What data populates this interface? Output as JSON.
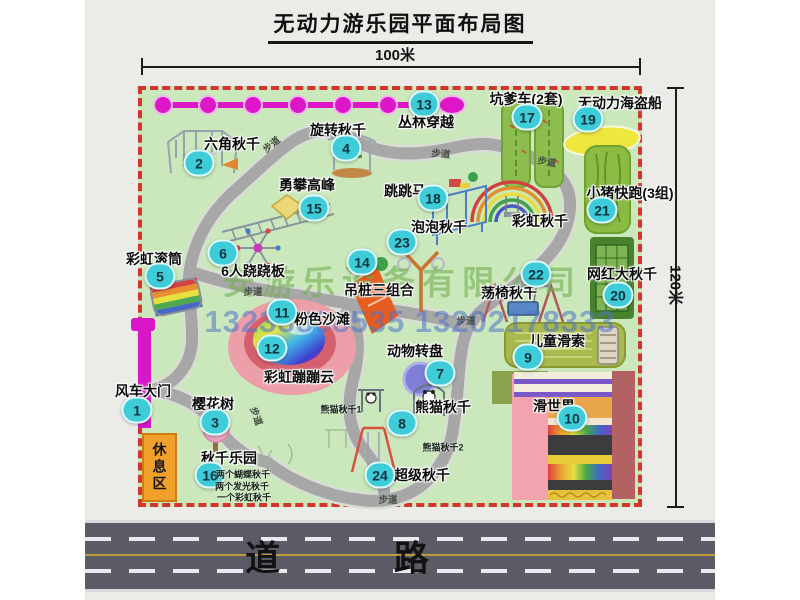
{
  "title": "无动力游乐园平面布局图",
  "dimensions": {
    "width_label": "100米",
    "height_label": "120米"
  },
  "watermark": {
    "company": "安游乐设备有限公司",
    "phones": "13233808535 13202178333"
  },
  "road": {
    "label": "道 路"
  },
  "rest_area": {
    "label": "休息区"
  },
  "colors": {
    "map_green": "#cae8bb",
    "border_red": "#d3342c",
    "badge_cyan": "#3ecdd8",
    "zipline_magenta": "#dd16c8",
    "gate_magenta": "#d818c8",
    "rest_orange": "#f2a02c",
    "road_gray": "#5b5b66",
    "walkway_gray": "#a7a7a7",
    "watermark_green": "#73af50",
    "watermark_blue": "#5073c8"
  },
  "map": {
    "items": [
      {
        "id": "1",
        "label": "风车大门",
        "lx": 143,
        "ly": 391,
        "bx": 137,
        "by": 410
      },
      {
        "id": "2",
        "label": "六角秋千",
        "lx": 232,
        "ly": 144,
        "bx": 199,
        "by": 163
      },
      {
        "id": "3",
        "label": "樱花树",
        "lx": 213,
        "ly": 404,
        "bx": 215,
        "by": 422
      },
      {
        "id": "4",
        "label": "旋转秋千",
        "lx": 338,
        "ly": 130,
        "bx": 346,
        "by": 148
      },
      {
        "id": "5",
        "label": "彩虹滚筒",
        "lx": 154,
        "ly": 259,
        "bx": 160,
        "by": 276
      },
      {
        "id": "6",
        "label": "6人跷跷板",
        "lx": 253,
        "ly": 271,
        "bx": 223,
        "by": 253
      },
      {
        "id": "7",
        "label": "动物转盘",
        "lx": 415,
        "ly": 351,
        "bx": 440,
        "by": 373
      },
      {
        "id": "8",
        "label": "熊猫秋千",
        "lx": 443,
        "ly": 407,
        "bx": 402,
        "by": 423,
        "notes": [
          {
            "text": "熊猫秋千1",
            "x": 341,
            "y": 409
          },
          {
            "text": "熊猫秋千2",
            "x": 443,
            "y": 447
          }
        ]
      },
      {
        "id": "9",
        "label": "儿童滑索",
        "lx": 557,
        "ly": 341,
        "bx": 528,
        "by": 357
      },
      {
        "id": "10",
        "label": "滑世界",
        "lx": 554,
        "ly": 406,
        "bx": 572,
        "by": 418
      },
      {
        "id": "11",
        "label": "粉色沙滩",
        "lx": 322,
        "ly": 319,
        "bx": 282,
        "by": 312
      },
      {
        "id": "12",
        "label": "彩虹蹦蹦云",
        "lx": 299,
        "ly": 377,
        "bx": 272,
        "by": 348
      },
      {
        "id": "13",
        "label": "丛林穿越",
        "lx": 426,
        "ly": 122,
        "bx": 424,
        "by": 104
      },
      {
        "id": "14",
        "label": "吊桩三组合",
        "lx": 379,
        "ly": 290,
        "bx": 362,
        "by": 262
      },
      {
        "id": "15",
        "label": "勇攀高峰",
        "lx": 307,
        "ly": 185,
        "bx": 314,
        "by": 208
      },
      {
        "id": "16",
        "label": "秋千乐园",
        "lx": 229,
        "ly": 458,
        "bx": 210,
        "by": 475,
        "notes": [
          {
            "text": "两个蝴蝶秋千",
            "x": 243,
            "y": 474
          },
          {
            "text": "两个发光秋千",
            "x": 242,
            "y": 486
          },
          {
            "text": "一个彩虹秋千",
            "x": 244,
            "y": 497
          }
        ]
      },
      {
        "id": "17",
        "label": "坑爹车(2套)",
        "lx": 526,
        "ly": 99,
        "bx": 527,
        "by": 117
      },
      {
        "id": "18",
        "label": "跳跳马",
        "lx": 405,
        "ly": 191,
        "bx": 433,
        "by": 198
      },
      {
        "id": "19",
        "label": "无动力海盗船",
        "lx": 620,
        "ly": 103,
        "bx": 588,
        "by": 119
      },
      {
        "id": "20",
        "label": "网红大秋千",
        "lx": 622,
        "ly": 274,
        "bx": 618,
        "by": 295
      },
      {
        "id": "21",
        "label": "小猪快跑(3组)",
        "lx": 630,
        "ly": 193,
        "bx": 602,
        "by": 210
      },
      {
        "id": "22",
        "label": "荡椅秋千",
        "lx": 509,
        "ly": 293,
        "bx": 536,
        "by": 274
      },
      {
        "id": "23",
        "label": "泡泡秋千",
        "lx": 439,
        "ly": 227,
        "bx": 402,
        "by": 242
      },
      {
        "id": "24",
        "label": "超级秋千",
        "lx": 422,
        "ly": 475,
        "bx": 380,
        "by": 475
      },
      {
        "id": null,
        "key": "rainbow-swing",
        "label": "彩虹秋千",
        "lx": 540,
        "ly": 221
      }
    ],
    "path_labels": [
      {
        "text": "步道",
        "x": 271,
        "y": 144,
        "rot": -40
      },
      {
        "text": "步道",
        "x": 441,
        "y": 153,
        "rot": 5
      },
      {
        "text": "步道",
        "x": 547,
        "y": 161,
        "rot": 10
      },
      {
        "text": "步道",
        "x": 253,
        "y": 291,
        "rot": 0
      },
      {
        "text": "步道",
        "x": 466,
        "y": 320,
        "rot": 0
      },
      {
        "text": "步道",
        "x": 257,
        "y": 416,
        "rot": 70
      },
      {
        "text": "步道",
        "x": 388,
        "y": 499,
        "rot": 0
      }
    ]
  }
}
